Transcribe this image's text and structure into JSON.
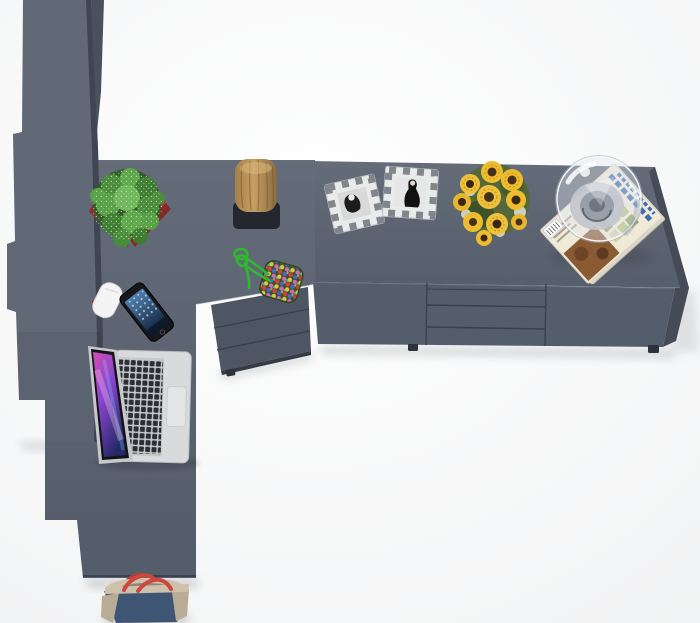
{
  "title": "Top view 3D render — anthracite L-shaped corner desk with wardrobe and sideboard",
  "colors": {
    "bg": "#fdfdfd",
    "desk_top": "#5b6371",
    "desk_front": "#545d6b",
    "desk_side_dark": "#454c58",
    "edge_dark": "#3c434e",
    "wardrobe_face": "#616977",
    "wardrobe_side": "#3f4652",
    "back_panel": "#4a515d",
    "drawer_unit": "#4e5663",
    "seam": "#39404b",
    "foot_dark": "#2e333b",
    "pot_red": "#a83a34",
    "pot_red_dark": "#812c28",
    "cactus_green": "#4d9040",
    "foliage_dark": "#2e5a28",
    "wood": "#b4905a",
    "wood_dark": "#7a5c33",
    "stump_base": "#24272d",
    "cord_green": "#2eb82e",
    "bead_mat": "#37522c",
    "frame_silver": "#e9eaea",
    "frame_checker": "#6e747c",
    "photo_dark": "#1c1c1c",
    "sunflower_yellow": "#edbd2f",
    "sunflower_center": "#46301a",
    "bouquet_green": "#55683c",
    "sprig_white": "#d9dbd2",
    "magazine_cover": "#efe9d8",
    "magazine_photo_brown": "#8a5a33",
    "masthead_blue": "#3e6cb2",
    "glass_stroke": "#f4f7fa",
    "dome_base_gray": "#c2c7ce",
    "laptop_silver": "#d8dadc",
    "key_black": "#2b2e33",
    "trackpad": "#e3e4e6",
    "screen_rim": "#c6c8ca",
    "bezel": "#141418",
    "phone_body": "#17181c",
    "bag_denim": "#3e5674",
    "bag_trim": "#b8ac97",
    "bag_band": "#cdc1ab",
    "bag_strap_red": "#cc4740",
    "white_object": "#f4f4f4"
  },
  "objects": [
    "wardrobe-tall-unit",
    "corner-desk-top",
    "sideboard",
    "sideboard-drawers",
    "under-desk-drawer-unit",
    "cactus-in-red-pot",
    "wood-stump-decor",
    "beaded-keychain-with-green-cord",
    "photo-frame-left",
    "photo-frame-right",
    "sunflower-bouquet",
    "glass-dome-on-magazines",
    "smartphone",
    "white-accessory",
    "laptop",
    "handbag"
  ]
}
